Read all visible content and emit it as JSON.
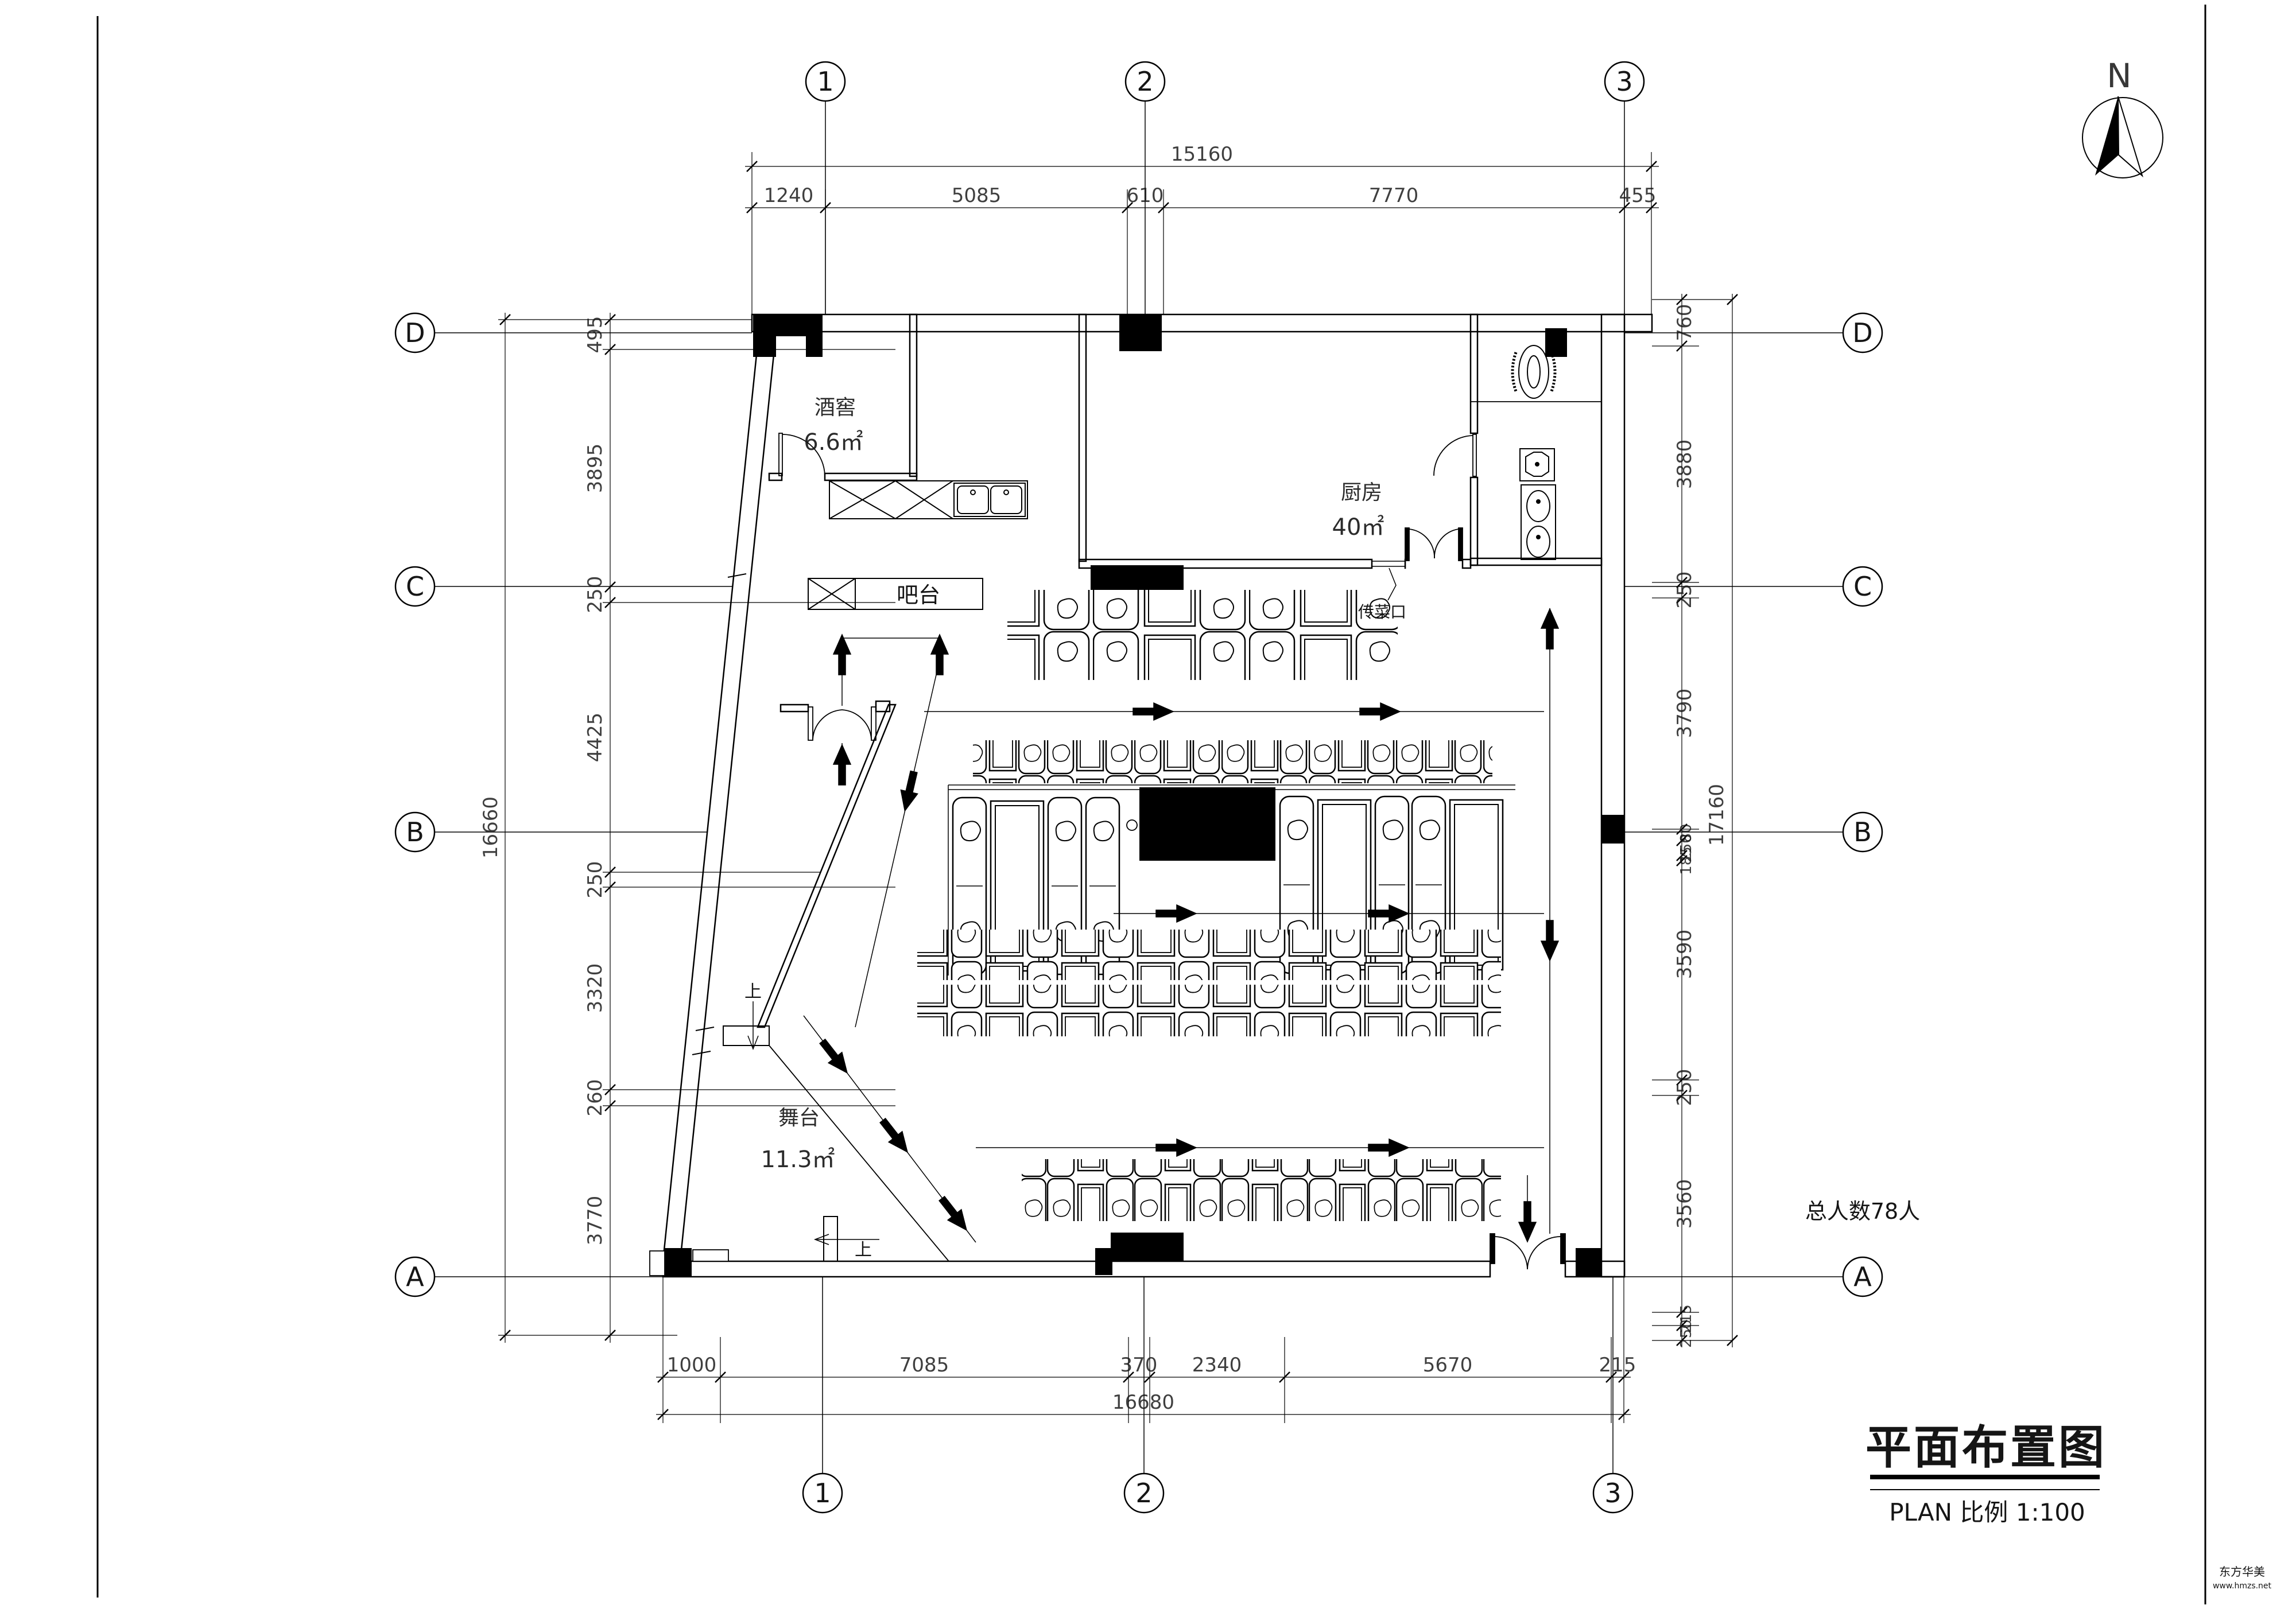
{
  "sheet": {
    "title": "平面布置图",
    "subtitle": "PLAN 比例 1:100",
    "north_label": "N",
    "capacity_note": "总人数78人",
    "watermark_line1": "东方华美",
    "watermark_line2": "www.hmzs.net"
  },
  "colors": {
    "ink": "#000000",
    "watermark": "#cc3333"
  },
  "grid": {
    "cols": [
      {
        "id": "1"
      },
      {
        "id": "2"
      },
      {
        "id": "3"
      }
    ],
    "rows": [
      {
        "id": "D"
      },
      {
        "id": "C"
      },
      {
        "id": "B"
      },
      {
        "id": "A"
      }
    ]
  },
  "dimensions": {
    "top": {
      "total": "15160",
      "segments": [
        "1240",
        "5085",
        "610",
        "7770",
        "455"
      ]
    },
    "bottom": {
      "total": "16680",
      "segments": [
        "1000",
        "7085",
        "370",
        "2340",
        "5670",
        "215"
      ]
    },
    "left": {
      "total": "16660",
      "segments": [
        "495",
        "3895",
        "250",
        "4425",
        "250",
        "3320",
        "260",
        "3770"
      ]
    },
    "right": {
      "total": "17160",
      "segments": [
        "760",
        "3880",
        "250",
        "3790",
        "80",
        "250",
        "185",
        "3590",
        "250",
        "3560",
        "215",
        "250"
      ]
    }
  },
  "rooms": [
    {
      "name": "酒窖",
      "area": "6.6㎡"
    },
    {
      "name": "厨房",
      "area": "40㎡"
    },
    {
      "name": "舞台",
      "area": "11.3㎡"
    }
  ],
  "labels": {
    "bar": "吧台",
    "pass": "传菜口",
    "up": "上"
  }
}
